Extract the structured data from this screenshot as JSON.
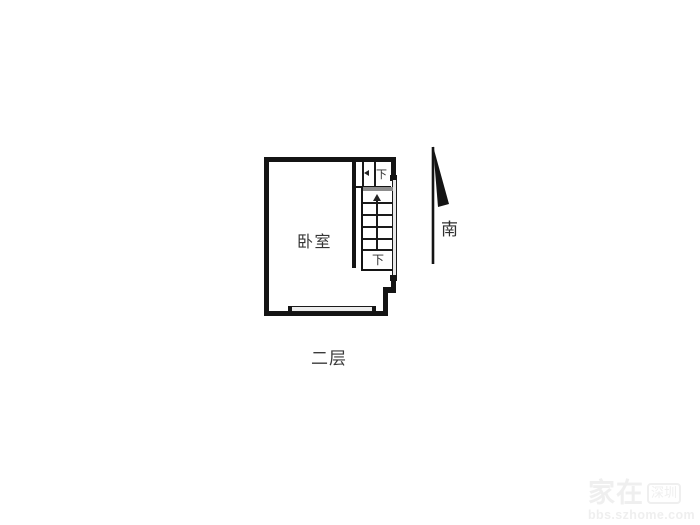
{
  "plan": {
    "room_label": "卧室",
    "floor_label": "二层",
    "compass_label": "南",
    "stair_upper_label": "下",
    "stair_lower_label": "下"
  },
  "watermark": {
    "brand": "家在",
    "region_badge": "深圳",
    "site": "bbs.szhome.com"
  },
  "colors": {
    "wall": "#141414",
    "label_text": "#3a3a3a",
    "watermark_text": "#efefef"
  }
}
